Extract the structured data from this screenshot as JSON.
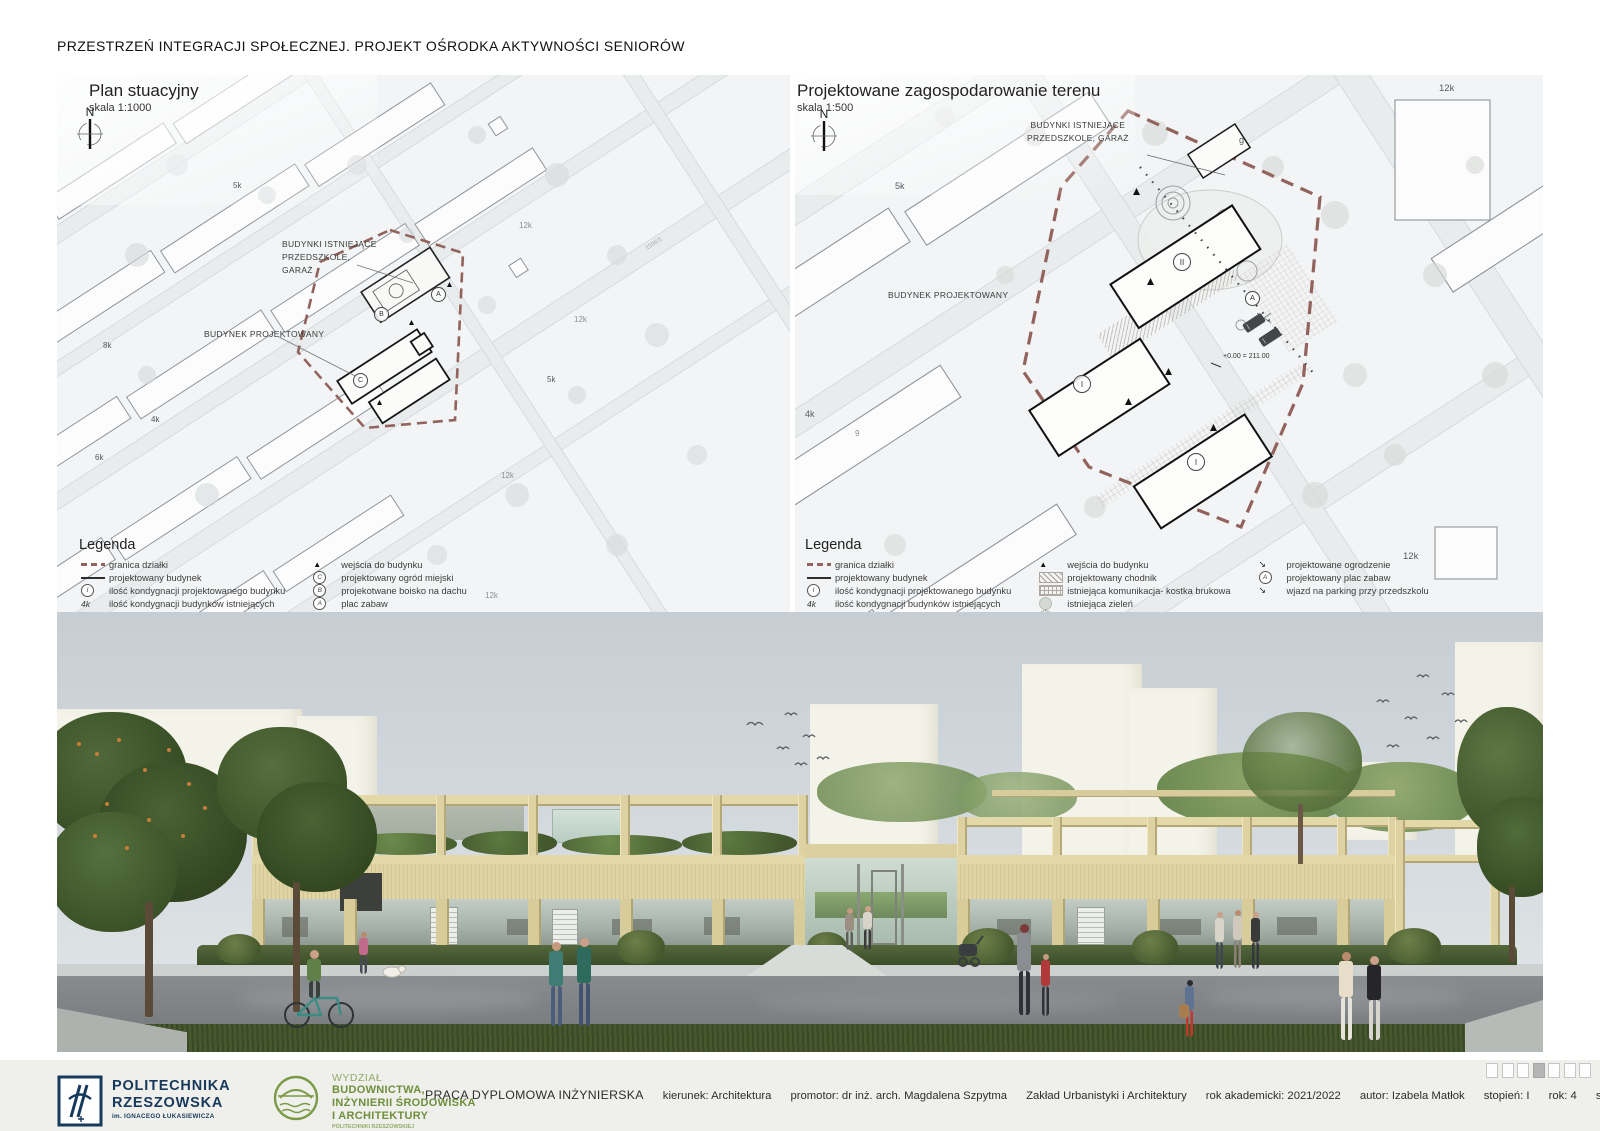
{
  "page": {
    "title": "PRZESTRZEŃ INTEGRACJI SPOŁECZNEJ. PROJEKT OŚRODKA AKTYWNOŚCI SENIORÓW"
  },
  "icons": {
    "triangle": "▲",
    "north": "N",
    "letter_a": "A",
    "letter_b": "B",
    "letter_c": "C",
    "roman_one": "I",
    "roman_two": "II",
    "storeys_existing": "4k",
    "fence_arrow": "↘",
    "drive_arrow": "↘",
    "garage": "g"
  },
  "plan_left": {
    "title": "Plan stuacyjny",
    "scale": "skala 1:1000",
    "label_existing_1": "BUDYNKI ISTNIEJĄCE",
    "label_existing_2": "PRZEDSZKOLE,",
    "label_existing_3": "GARAŻ",
    "label_proposed": "BUDYNEK PROJEKTOWANY",
    "annotations": {
      "a1": "5k",
      "a2": "4k",
      "a3": "8k",
      "a4": "6k",
      "a5": "5k",
      "a6": "12k",
      "a7": "12k",
      "a8": "12k",
      "a9": "12k",
      "a10": "1596/1"
    }
  },
  "plan_right": {
    "title": "Projektowane zagospodarowanie terenu",
    "scale": "skala 1:500",
    "label_existing_1": "BUDYNKI ISTNIEJĄCE",
    "label_existing_2": "PRZEDSZKOLE, GARAŻ",
    "label_proposed": "BUDYNEK PROJEKTOWANY",
    "level_mark": "+0.00 = 211.00",
    "annotations": {
      "a1": "5k",
      "a2": "4k",
      "a3": "9",
      "a4": "12k",
      "a5": "12k"
    }
  },
  "legend_left": {
    "title": "Legenda",
    "col1": [
      {
        "label": "granica działki"
      },
      {
        "label": "projektowany budynek"
      },
      {
        "label": "ilość kondygnacji projektowanego budynku"
      },
      {
        "label": "ilość kondygnacji budynków istniejących"
      },
      {
        "label": "główne wejście do budynku"
      }
    ],
    "col2": [
      {
        "label": "wejścia do budynku"
      },
      {
        "label": "projektowany ogród miejski"
      },
      {
        "label": "projekotwane boisko na dachu"
      },
      {
        "label": "plac zabaw"
      },
      {
        "label": "projektowana komunikacja"
      }
    ]
  },
  "legend_right": {
    "title": "Legenda",
    "col1": [
      {
        "label": "granica działki"
      },
      {
        "label": "projektowany budynek"
      },
      {
        "label": "ilość kondygnacji projektowanego budynku"
      },
      {
        "label": "ilość kondygnacji budynków istniejących"
      },
      {
        "label": "główne wejście do budynku"
      }
    ],
    "col2": [
      {
        "label": "wejścia do budynku"
      },
      {
        "label": "projektowany chodnik"
      },
      {
        "label": "istniejąca komunikacja- kostka brukowa"
      },
      {
        "label": "istniejąca zieleń"
      },
      {
        "label": "projektowana zieleń"
      }
    ],
    "col3": [
      {
        "label": "projektowane ogrodzenie"
      },
      {
        "label": "projektowany plac zabaw"
      },
      {
        "label": "wjazd na parking przy przedszkolu"
      }
    ]
  },
  "footer": {
    "university": {
      "line1": "POLITECHNIKA",
      "line2": "RZESZOWSKA",
      "line3": "im. IGNACEGO ŁUKASIEWICZA"
    },
    "faculty": {
      "line0": "WYDZIAŁ",
      "line1": "BUDOWNICTWA,",
      "line2": "INŻYNIERII ŚRODOWISKA",
      "line3": "I ARCHITEKTURY",
      "line4": "POLITECHNIKI RZESZOWSKIEJ"
    },
    "thesis": {
      "type": "PRACA DYPLOMOWA INŻYNIERSKA",
      "field": "kierunek: Architektura",
      "promoter": "promotor: dr inż. arch. Magdalena Szpytma",
      "department": "Zakład Urbanistyki i Architektury",
      "year": "rok akademicki: 2021/2022",
      "author": "autor: Izabela Matłok",
      "degree": "stopień: I",
      "study_year": "rok: 4",
      "semester": "semestr: 7"
    },
    "pagination": {
      "total": 7,
      "active_index": 3
    }
  },
  "colors": {
    "boundary": "#92625c",
    "navy": "#17395c",
    "green": "#74923e",
    "building_beige": "#ddd2a0"
  }
}
